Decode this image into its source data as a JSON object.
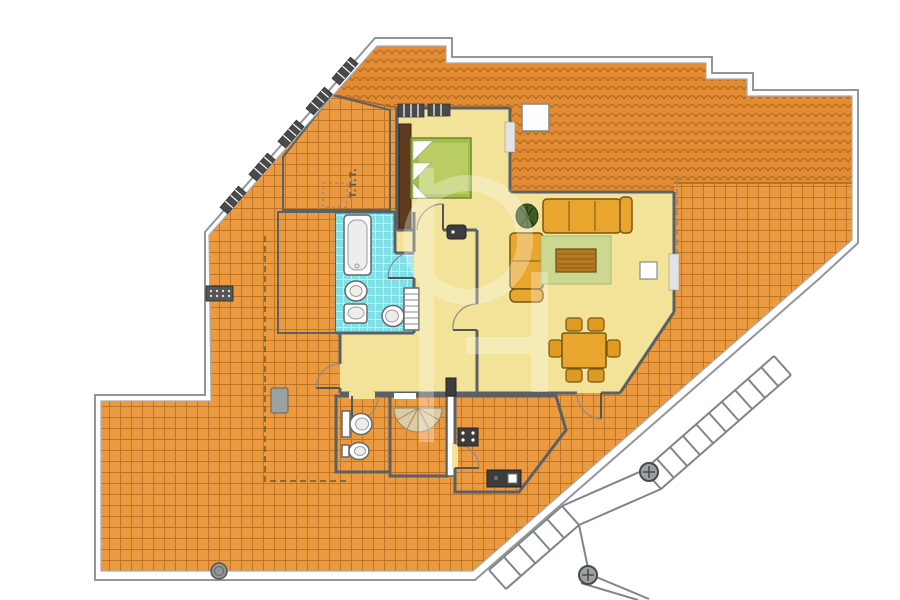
{
  "meta": {
    "type": "architectural-floor-plan",
    "canvas_width": 900,
    "canvas_height": 600
  },
  "labels": {
    "attic_room": "T.T.T."
  },
  "watermark": {
    "style": "translucent-white-logo",
    "opacity": 0.3
  },
  "colors": {
    "terrace": "#ec9a40",
    "terrace_grout": "#a5611c",
    "roof": "#e28b33",
    "roof_line": "#9c5a18",
    "interior": "#f2e398",
    "wet": "#7fe0e8",
    "wet_grout": "#c9f4f7",
    "wall": "#5a6065",
    "outline": "#8f979c",
    "bed": "#a3bd4e",
    "bed_duvet": "#b9cd63",
    "rug": "#ccd792",
    "sofa": "#e8a62e",
    "sofa_edge": "#7a5510",
    "wood": "#b5791f",
    "stair_tread": "#dccba4",
    "fixture_dark": "#3d3d3d",
    "metal": "#8f9598",
    "plant": "#3d5b22"
  },
  "rooms": [
    {
      "name": "wraparound-terrace",
      "floor": "orange-tile-grid"
    },
    {
      "name": "roof-band",
      "floor": "orange-roof-tiles"
    },
    {
      "name": "attic-room",
      "floor": "white",
      "label": "T.T.T."
    },
    {
      "name": "lightwell-void",
      "floor": "white"
    },
    {
      "name": "bedroom",
      "floor": "yellow"
    },
    {
      "name": "hall",
      "floor": "yellow"
    },
    {
      "name": "living-dining-room",
      "floor": "yellow"
    },
    {
      "name": "bathroom",
      "floor": "cyan-tile"
    },
    {
      "name": "wc",
      "floor": "cyan-tile"
    },
    {
      "name": "kitchen",
      "floor": "cyan-tile"
    },
    {
      "name": "spiral-stair-room",
      "floor": "white"
    }
  ],
  "furniture": [
    "double-bed",
    "wardrobe",
    "corner-sofa",
    "plant",
    "rug",
    "coffee-table",
    "side-table",
    "dining-table-six-chairs",
    "bathtub",
    "bidet",
    "washbasin",
    "toilet",
    "radiator",
    "wc-toilet",
    "wc-bidet",
    "stove",
    "kitchen-counter",
    "wall-unit",
    "spiral-staircase",
    "exterior-staircase",
    "chimney",
    "planter",
    "drain",
    "vent-grille"
  ]
}
